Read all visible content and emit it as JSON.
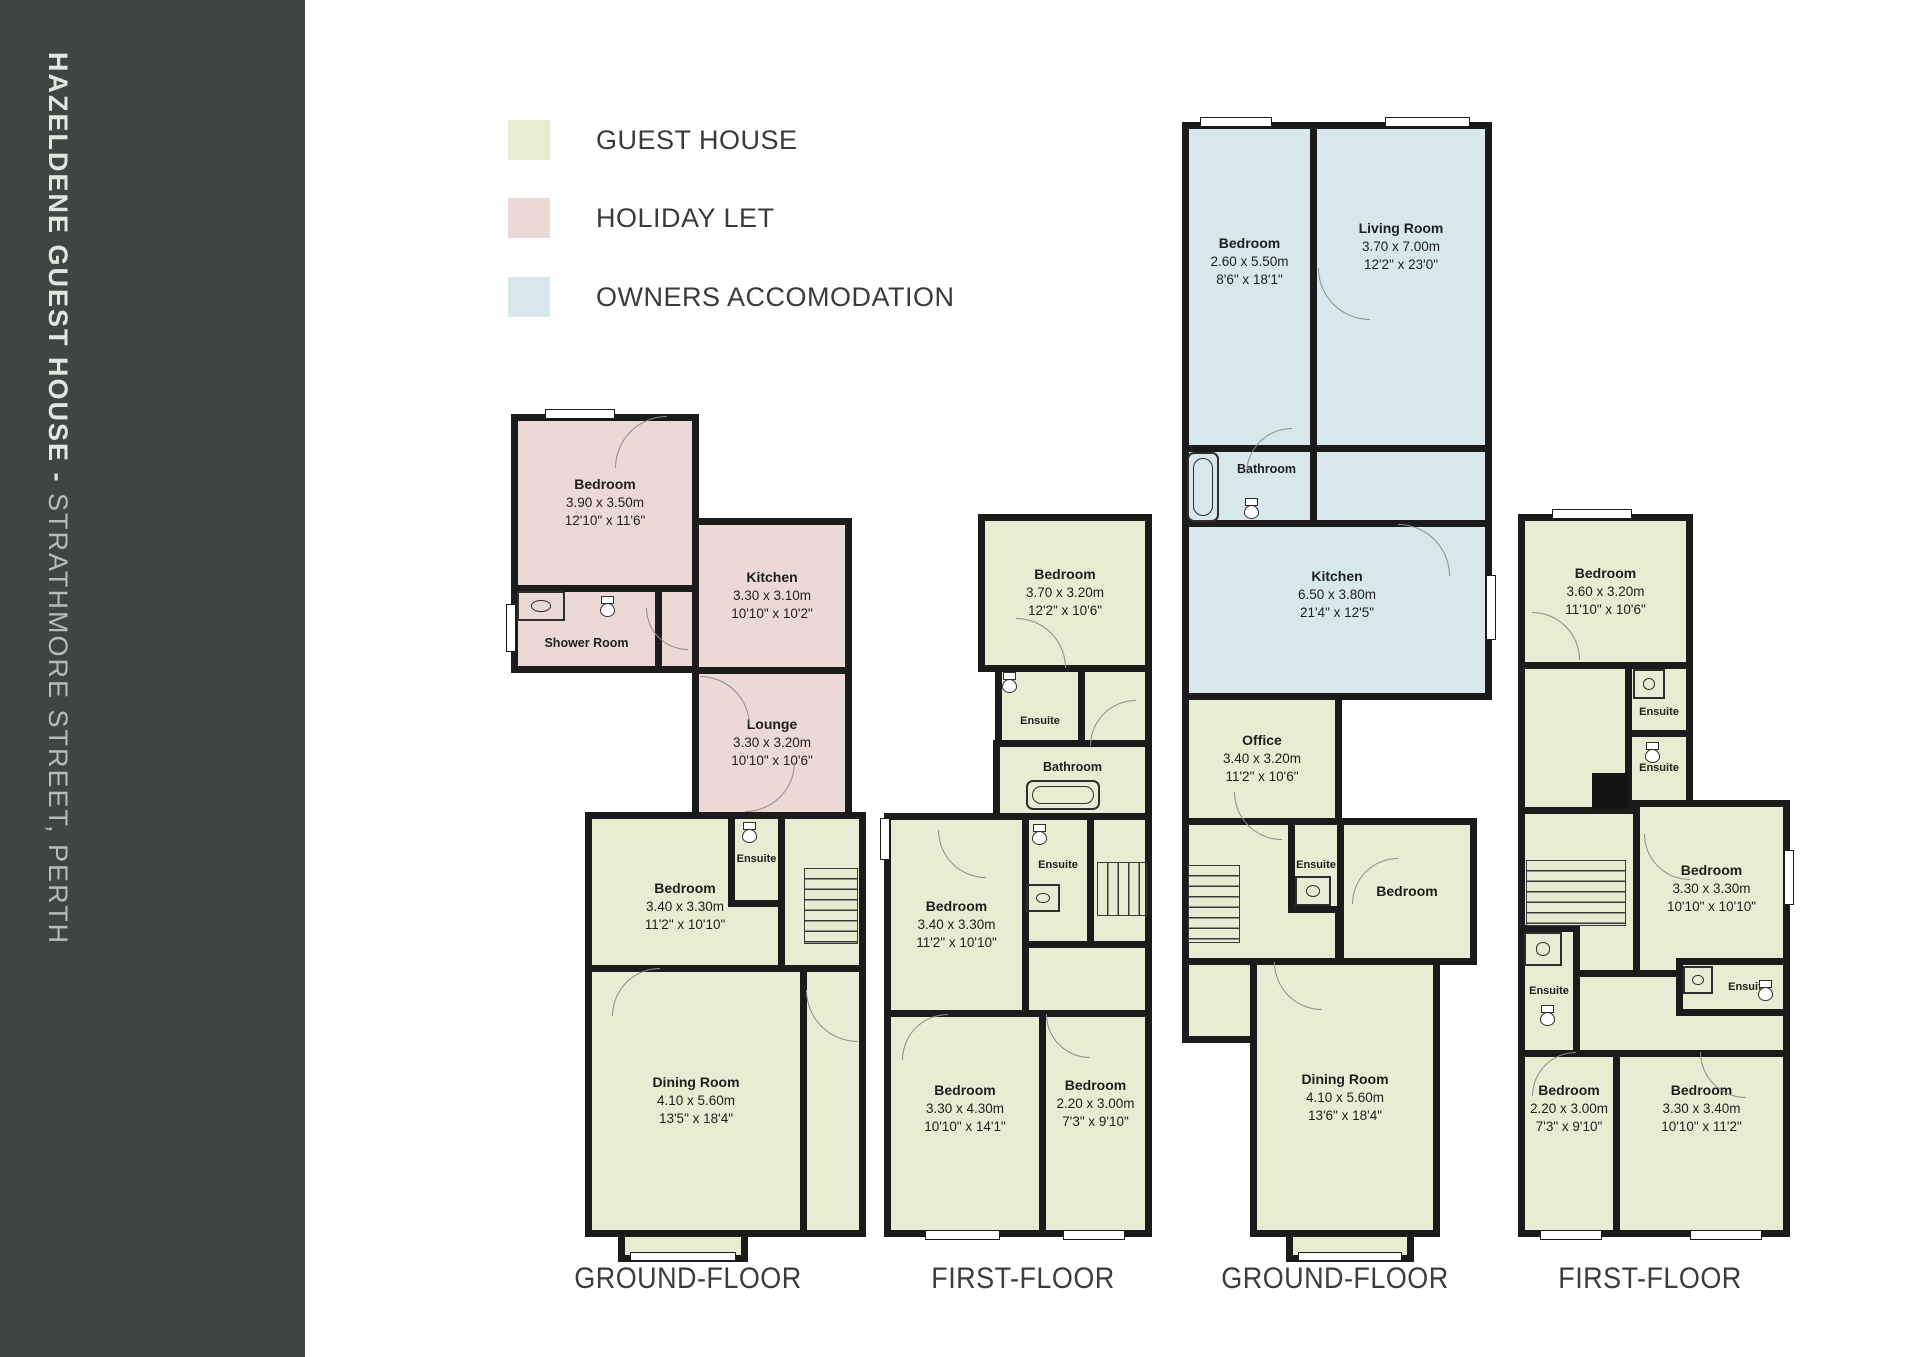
{
  "sidebar": {
    "title_bold": "HAZELDENE GUEST HOUSE - ",
    "title_regular": "STRATHMORE STREET, PERTH"
  },
  "legend": {
    "items": [
      {
        "label": "GUEST HOUSE",
        "color": "#e9ecd2"
      },
      {
        "label": "HOLIDAY LET",
        "color": "#ecd9d7"
      },
      {
        "label": "OWNERS ACCOMODATION",
        "color": "#d6e8ea"
      }
    ]
  },
  "plans": [
    {
      "floor_label": "GROUND-FLOOR",
      "rooms": [
        {
          "name": "Bedroom",
          "metric": "3.90 x 3.50m",
          "imperial": "12'10\" x 11'6\""
        },
        {
          "name": "Shower Room"
        },
        {
          "name": "Kitchen",
          "metric": "3.30 x 3.10m",
          "imperial": "10'10\" x 10'2\""
        },
        {
          "name": "Lounge",
          "metric": "3.30 x 3.20m",
          "imperial": "10'10\" x 10'6\""
        },
        {
          "name": "Bedroom",
          "metric": "3.40 x 3.30m",
          "imperial": "11'2\" x 10'10\""
        },
        {
          "name": "Ensuite"
        },
        {
          "name": "Dining Room",
          "metric": "4.10 x 5.60m",
          "imperial": "13'5\" x 18'4\""
        }
      ]
    },
    {
      "floor_label": "FIRST-FLOOR",
      "rooms": [
        {
          "name": "Bedroom",
          "metric": "3.70 x 3.20m",
          "imperial": "12'2\" x 10'6\""
        },
        {
          "name": "Ensuite"
        },
        {
          "name": "Bathroom"
        },
        {
          "name": "Bedroom",
          "metric": "3.40 x 3.30m",
          "imperial": "11'2\" x 10'10\""
        },
        {
          "name": "Ensuite"
        },
        {
          "name": "Bedroom",
          "metric": "3.30 x 4.30m",
          "imperial": "10'10\" x 14'1\""
        },
        {
          "name": "Bedroom",
          "metric": "2.20 x 3.00m",
          "imperial": "7'3\" x 9'10\""
        }
      ]
    },
    {
      "floor_label": "GROUND-FLOOR",
      "rooms": [
        {
          "name": "Bedroom",
          "metric": "2.60 x 5.50m",
          "imperial": "8'6\" x 18'1\""
        },
        {
          "name": "Living Room",
          "metric": "3.70 x 7.00m",
          "imperial": "12'2\" x 23'0\""
        },
        {
          "name": "Bathroom"
        },
        {
          "name": "Kitchen",
          "metric": "6.50 x 3.80m",
          "imperial": "21'4\" x 12'5\""
        },
        {
          "name": "Office",
          "metric": "3.40 x 3.20m",
          "imperial": "11'2\" x 10'6\""
        },
        {
          "name": "Ensuite"
        },
        {
          "name": "Bedroom"
        },
        {
          "name": "Dining Room",
          "metric": "4.10 x 5.60m",
          "imperial": "13'6\" x 18'4\""
        }
      ]
    },
    {
      "floor_label": "FIRST-FLOOR",
      "rooms": [
        {
          "name": "Bedroom",
          "metric": "3.60 x 3.20m",
          "imperial": "11'10\" x 10'6\""
        },
        {
          "name": "Ensuite"
        },
        {
          "name": "Ensuite"
        },
        {
          "name": "Bedroom",
          "metric": "3.30 x 3.30m",
          "imperial": "10'10\" x 10'10\""
        },
        {
          "name": "Ensuite"
        },
        {
          "name": "Ensuite"
        },
        {
          "name": "Bedroom",
          "metric": "2.20 x 3.00m",
          "imperial": "7'3\" x 9'10\""
        },
        {
          "name": "Bedroom",
          "metric": "3.30 x 3.40m",
          "imperial": "10'10\" x 11'2\""
        }
      ]
    }
  ]
}
